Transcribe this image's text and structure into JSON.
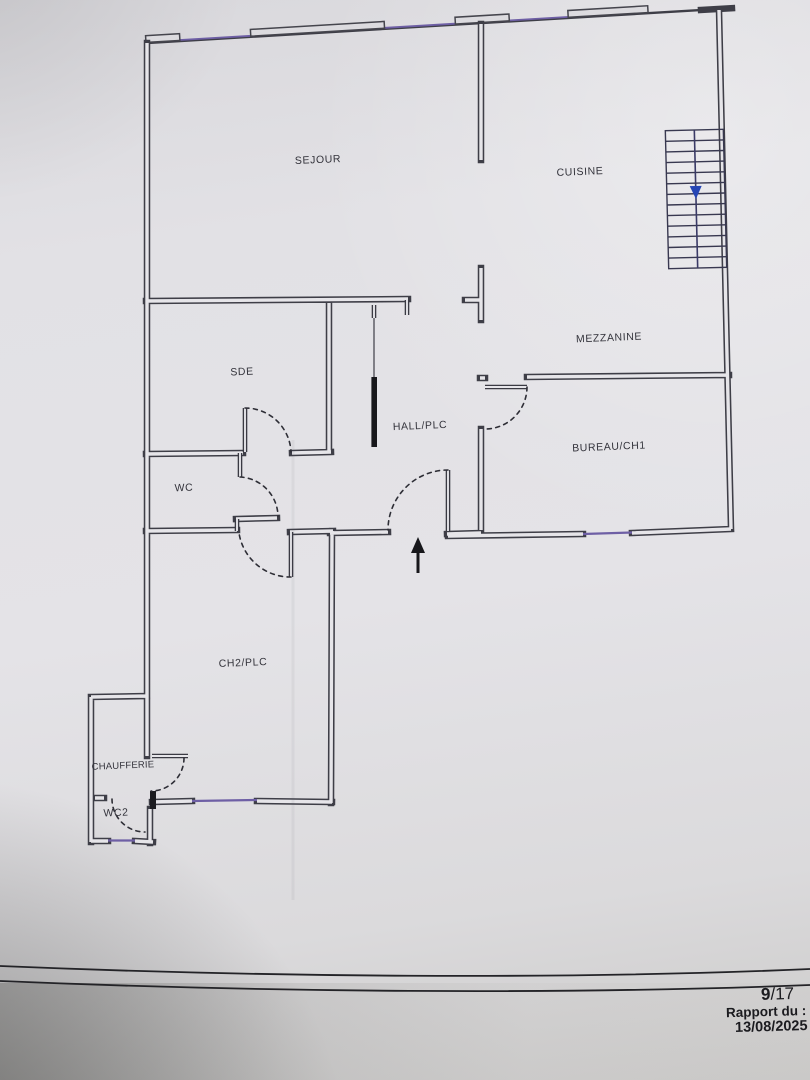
{
  "plan": {
    "rooms": [
      {
        "id": "sejour",
        "label": "SEJOUR"
      },
      {
        "id": "cuisine",
        "label": "CUISINE"
      },
      {
        "id": "mezzanine",
        "label": "MEZZANINE"
      },
      {
        "id": "sde",
        "label": "SDE"
      },
      {
        "id": "hall",
        "label": "HALL/PLC"
      },
      {
        "id": "bureau",
        "label": "BUREAU/CH1"
      },
      {
        "id": "wc",
        "label": "WC"
      },
      {
        "id": "ch2",
        "label": "CH2/PLC"
      },
      {
        "id": "chaufferie",
        "label": "CHAUFFERIE"
      },
      {
        "id": "wc2",
        "label": "WC2"
      }
    ],
    "stairs": {
      "treads": 13,
      "arrow_direction": "down"
    },
    "entrance_arrow_direction": "up",
    "colors": {
      "wall": "#3e3e47",
      "window_glass": "#6e5fa5",
      "stair_arrow": "#2545b5",
      "paper": "#e4e3e7",
      "label_text": "#33333b"
    }
  },
  "footer": {
    "page_current": "9",
    "page_rest": "/17",
    "report_label": "Rapport du :",
    "report_date": "13/08/2025"
  }
}
